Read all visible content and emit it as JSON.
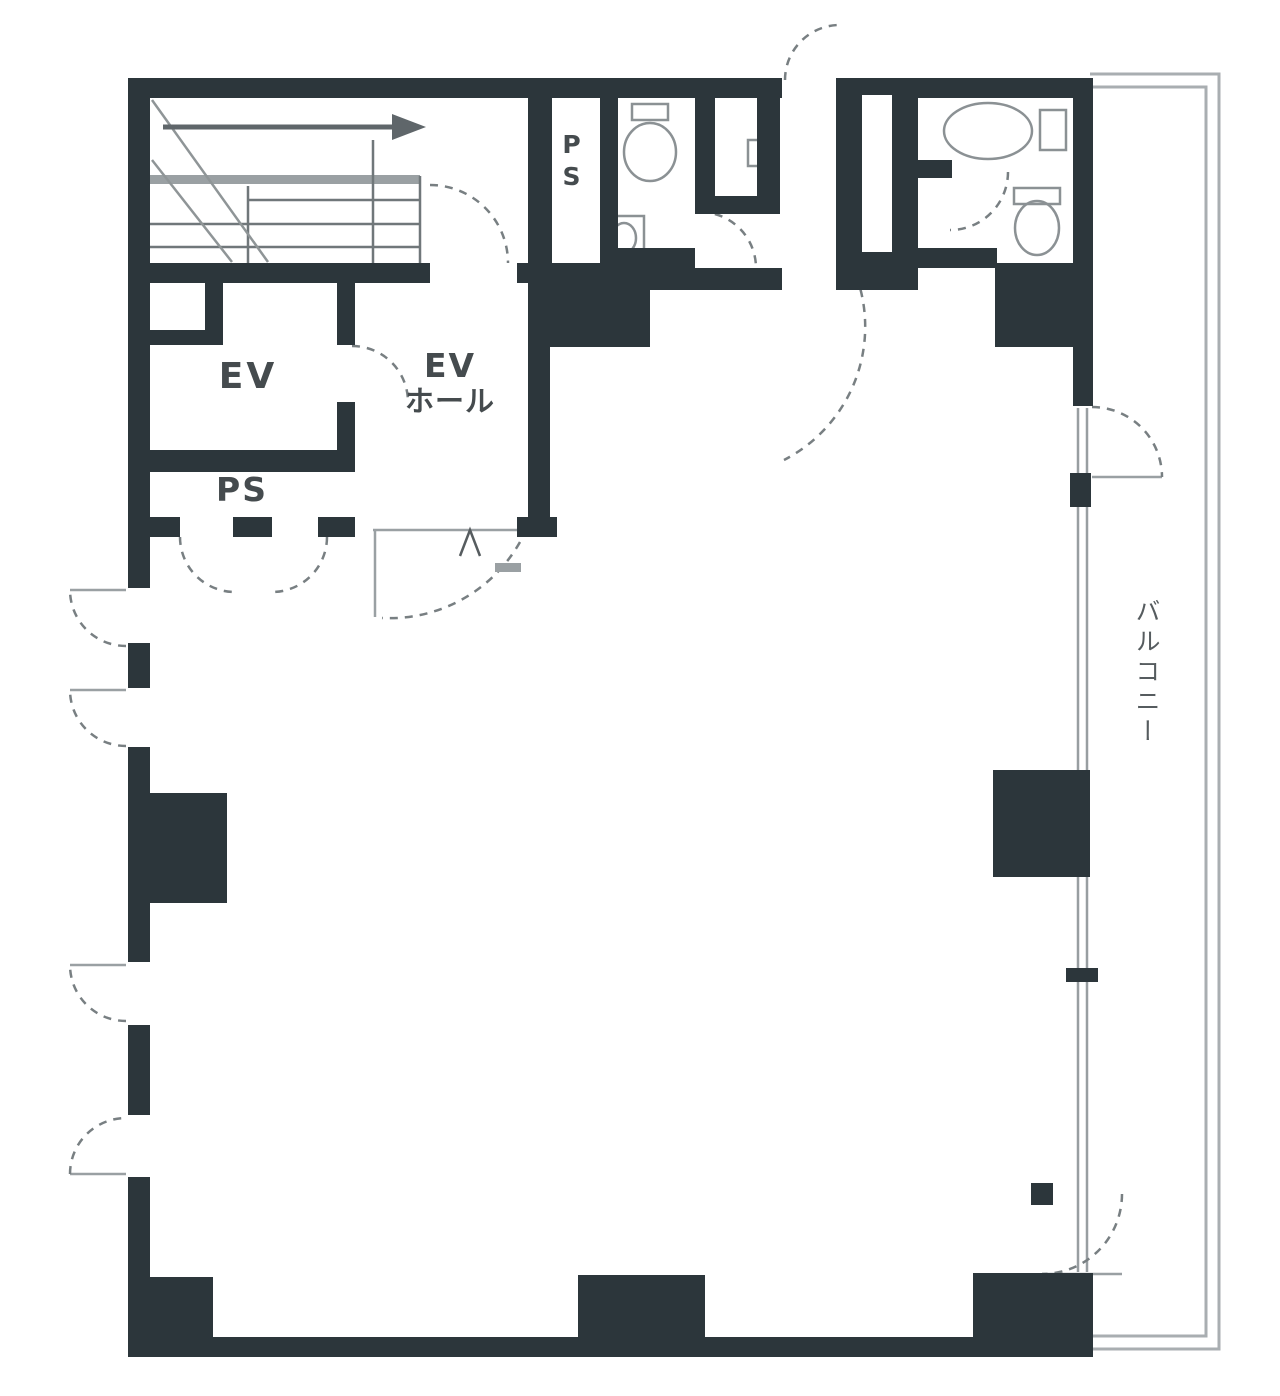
{
  "plan": {
    "type": "floor-plan",
    "rooms": {
      "elevator": {
        "label": "EV"
      },
      "elevator_hall": {
        "label_line1": "EV",
        "label_line2": "ホール"
      },
      "pipe_shaft_main": {
        "label": "PS"
      },
      "pipe_shaft_top": {
        "label": "PS"
      },
      "balcony": {
        "label": "バルコニー"
      }
    },
    "colors": {
      "wall": "#2c363b",
      "thin_line": "#8f9597",
      "light_line": "#a9aeb1",
      "text": "#454b4e",
      "background": "#ffffff"
    }
  }
}
